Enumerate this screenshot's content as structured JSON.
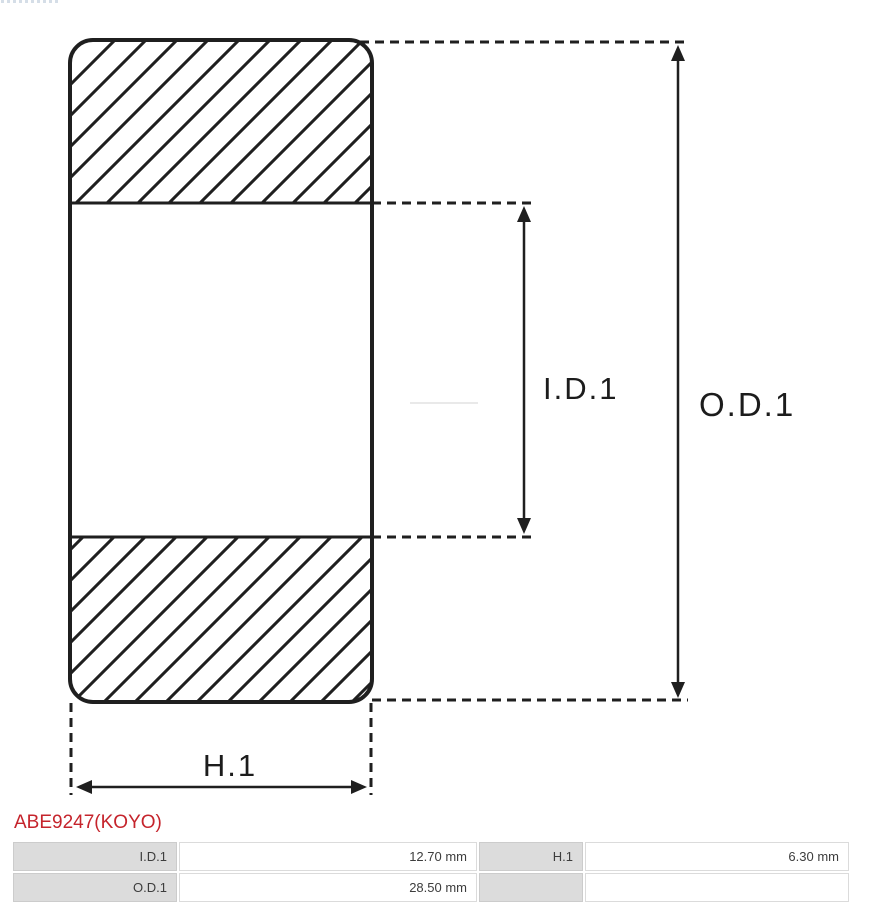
{
  "diagram": {
    "labels": {
      "inner_diameter": "I.D.1",
      "outer_diameter": "O.D.1",
      "height": "H.1"
    },
    "line_color": "#1f1f1f",
    "type": "bearing-cross-section"
  },
  "part": {
    "number": "ABE9247(KOYO)",
    "number_color": "#c5242c"
  },
  "spec_table": {
    "label_cell_color": "#dcdcdc",
    "rows": [
      {
        "c0": "I.D.1",
        "c1": "12.70 mm",
        "c2": "H.1",
        "c3": "6.30 mm"
      },
      {
        "c0": "O.D.1",
        "c1": "28.50 mm",
        "c2": "",
        "c3": ""
      }
    ]
  }
}
